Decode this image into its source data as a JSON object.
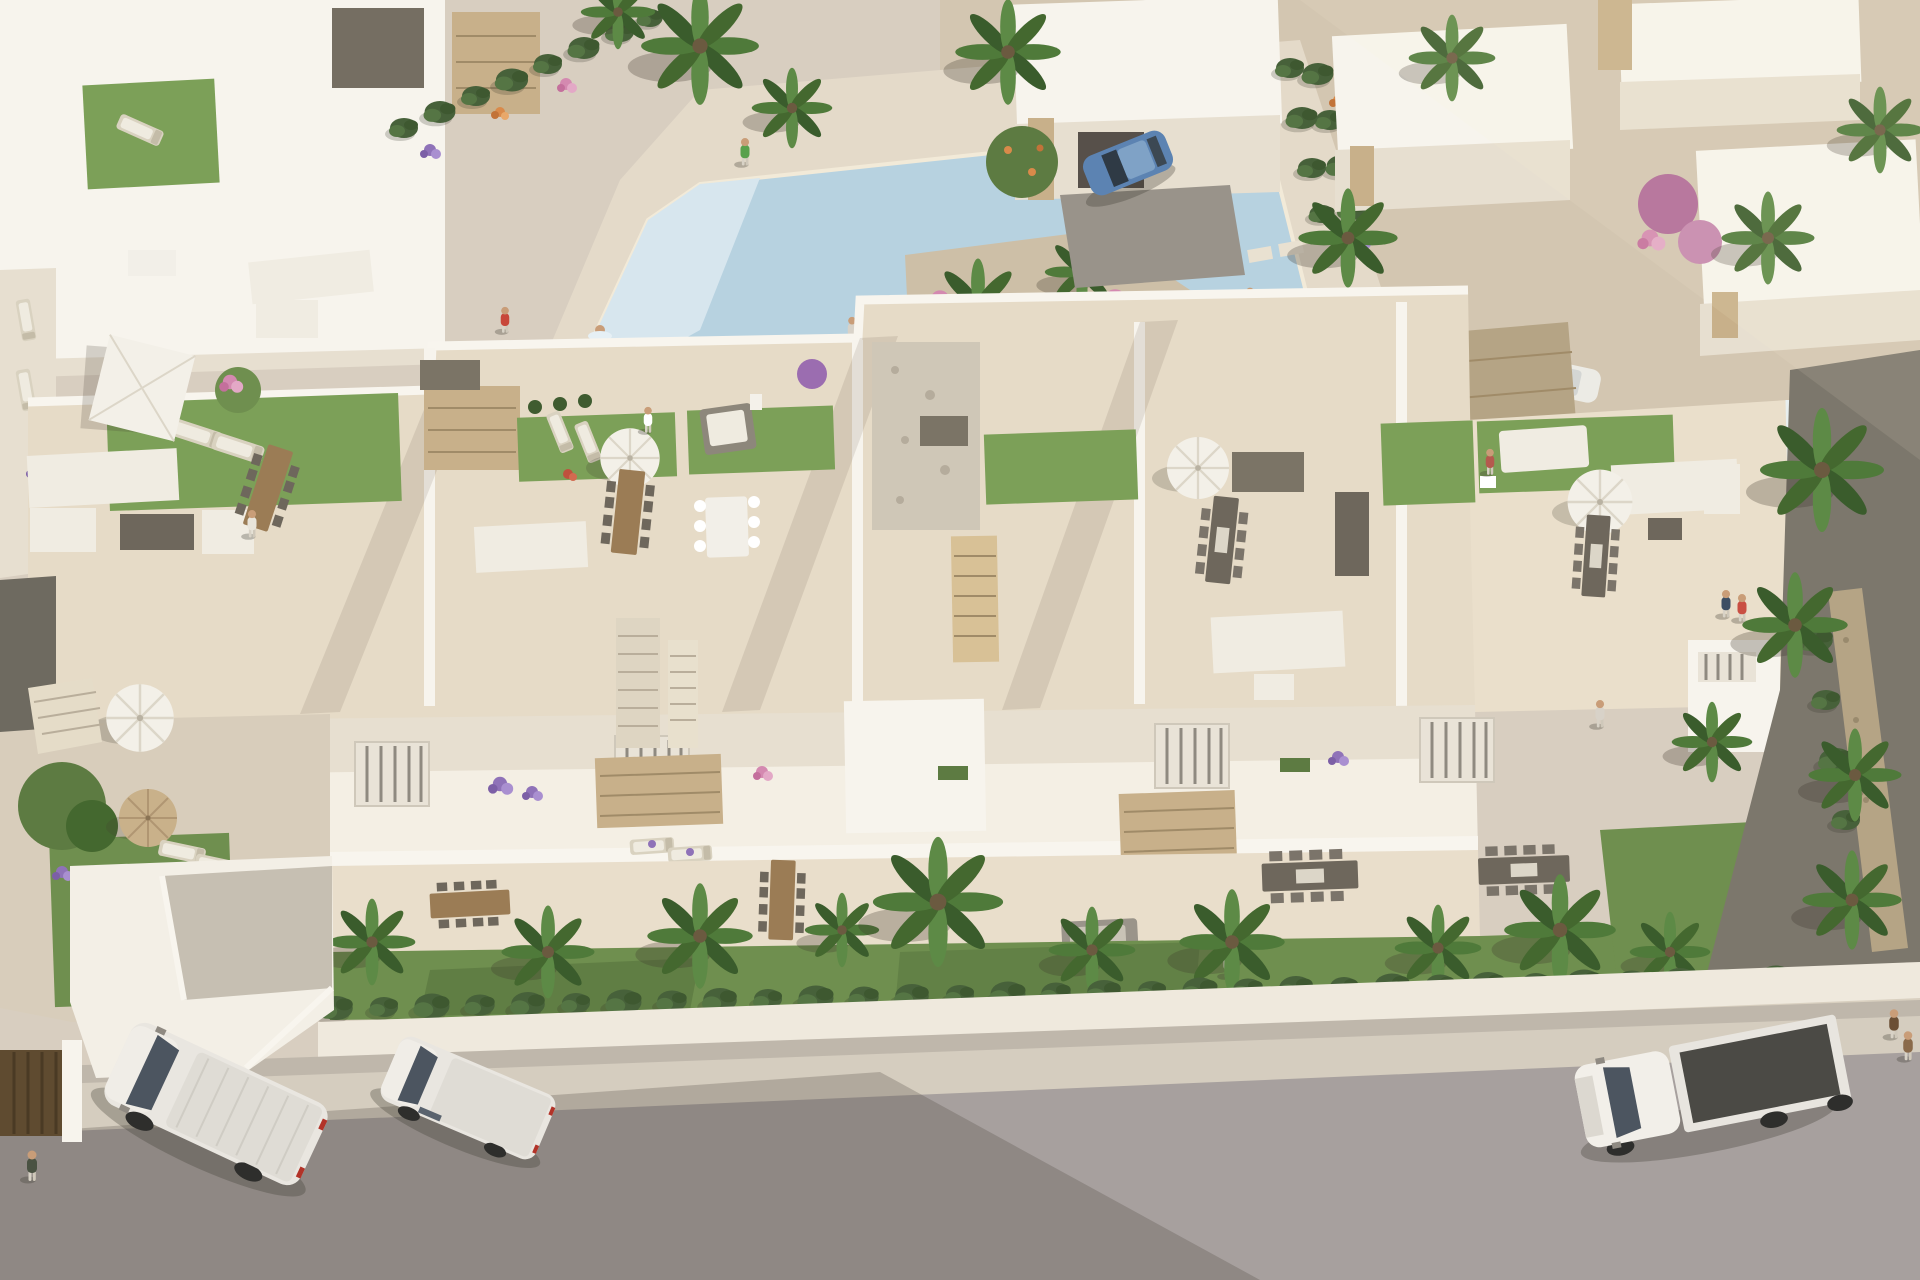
{
  "scene": {
    "alt_text": "Aerial 3D architectural rendering of a modern white residential complex: an apartment block with rooftop solarium terraces (artificial lawns, white parasols, outdoor lounge and dining furniture), a communal swimming pool with a planted palm island, surrounding white villas with stone accents, private gardens with palm trees and box hedges, and a foreground street with parked vans, a flatbed truck and pedestrians in warm evening light.",
    "areas": [
      "communal pool plaza",
      "background villas",
      "apartment block with rooftop terraces",
      "private gardens and terraces",
      "street with parked vehicles"
    ],
    "vehicles": [
      {
        "name": "panel van",
        "color": "white"
      },
      {
        "name": "compact van",
        "color": "white"
      },
      {
        "name": "flatbed truck",
        "color": "white",
        "bed_color": "dark gray"
      },
      {
        "name": "hatchback",
        "color": "blue"
      },
      {
        "name": "parked car",
        "color": "white"
      }
    ],
    "vegetation": {
      "palm_trees": 30,
      "hedge_rows": 3,
      "flower_colors": [
        "purple",
        "pink",
        "orange",
        "red",
        "white"
      ]
    },
    "people_visible": 14,
    "outdoor_furniture": [
      "square parasol",
      "round parasols",
      "sun loungers",
      "corner sofas",
      "dining tables",
      "daybeds",
      "fire table"
    ]
  },
  "palette": {
    "plaza": "#d8cec0",
    "deck": "#e4dac9",
    "pool_water": "#b7d2e0",
    "pool_steps": "#d7e6ee",
    "island_sand": "#cdbfa7",
    "roof_floor": "#e6dbc7",
    "roof_floor_right": "#eadfcb",
    "wall_white": "#f7f4ed",
    "wall_shade": "#e7dfd0",
    "stone_clad": "#c8b08a",
    "lawn": "#7ca058",
    "grass": "#6f8f4f",
    "hedge": "#47613a",
    "palm_frond": "#4f7a3a",
    "trunk": "#8a795c",
    "gravel": "#8b867c",
    "street_wall": "#efe9dd",
    "sidewalk": "#d5cdbf",
    "road": "#a7a09e",
    "van_body": "#e9e6e0",
    "truck_bed": "#4b4a45",
    "blue_car": "#5c83b2",
    "umbrella": "#f3f0e8",
    "umbrella_tan": "#c9b18a",
    "villa_yard": "#d3c6b1"
  }
}
